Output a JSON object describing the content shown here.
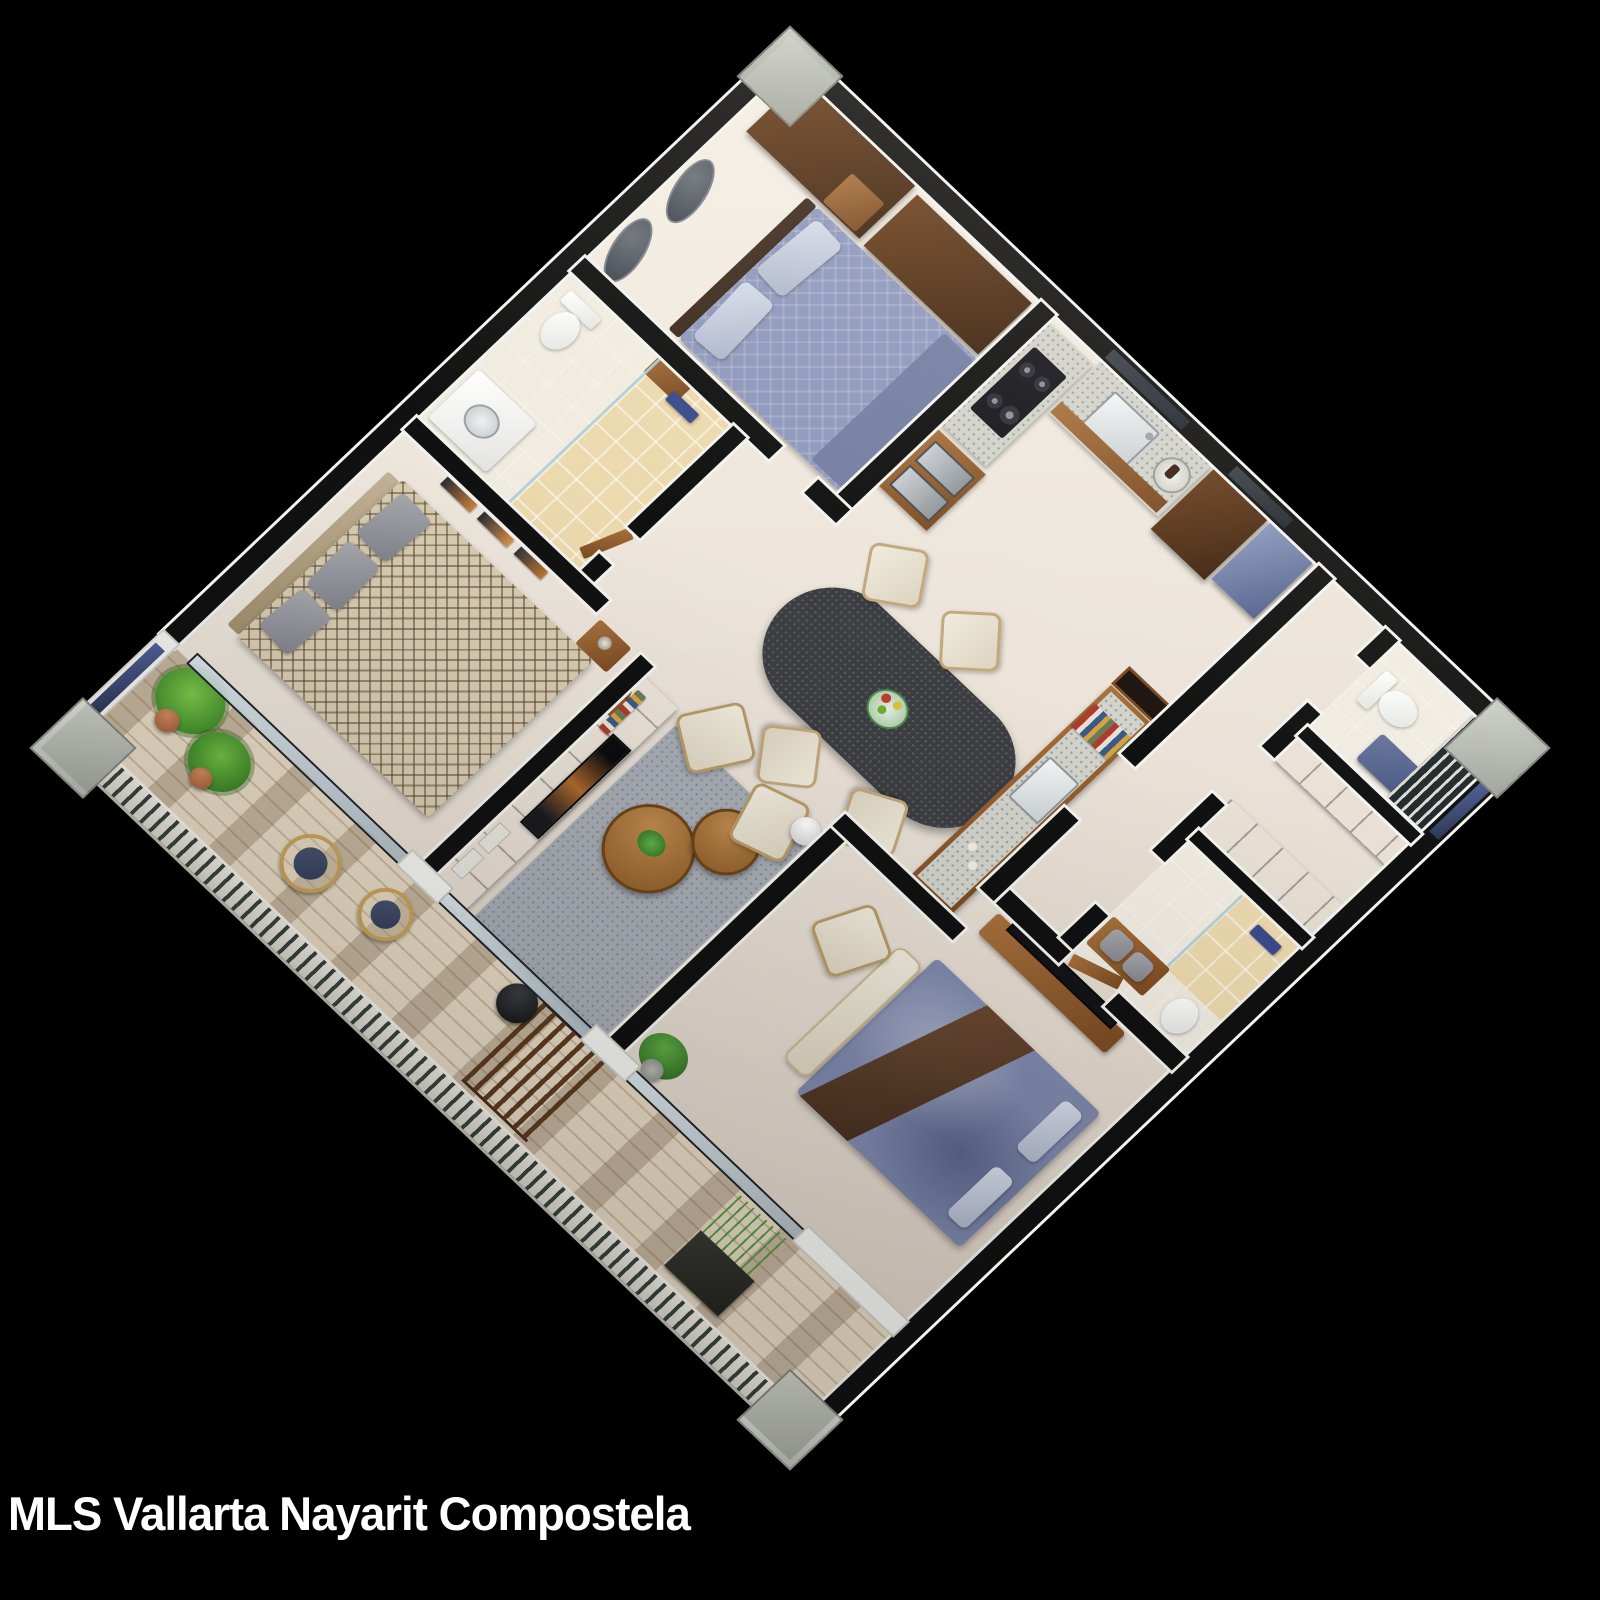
{
  "caption": {
    "text": "MLS Vallarta Nayarit Compostela"
  },
  "scene": {
    "type": "isometric-3d-floor-plan",
    "view": "axonometric-45deg",
    "background": "black"
  },
  "palette": {
    "bg": "#000000",
    "floor": "#ece4da",
    "wallDark": "#111111",
    "wallLight": "#f4f4f1",
    "wood": "#8a5a2e",
    "woodDark": "#4a2a12",
    "terrazzo": "#d2d3cb",
    "rug": "#a8adb5",
    "bedBlue": "#8e98bc",
    "bedChevron": "#d9cdb2",
    "deck": "#e7dac4",
    "railing": "#e8e8e2",
    "green": "#4e9a3a",
    "terracotta": "#b5714f",
    "tableDark": "#3c3e42",
    "cream": "#e9e3d3",
    "tile": "#ecd9ae",
    "accentBlue": "#3a4a8c",
    "steelBlue": "#6b7aa8",
    "caption": "#ffffff"
  }
}
